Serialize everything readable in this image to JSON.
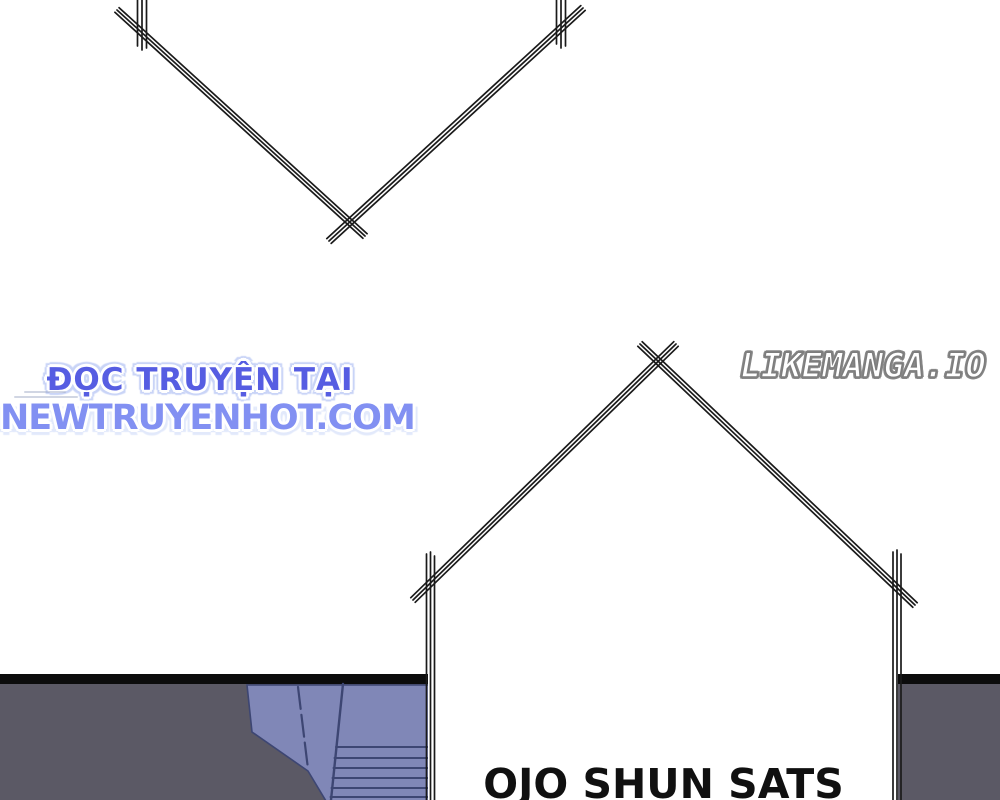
{
  "artwork": {
    "dialogue_text": "OJO SHUN SATS",
    "scene": "manga page with chevron panel border, house-shaped bubble outline, dark floor panel and blue staircase"
  },
  "watermarks": {
    "reader_line1": "ĐỌC TRUYỆN TẠI",
    "reader_line2": "NEWTRUYENHOT.COM",
    "site": "LIKEMANGA.IO"
  },
  "colors": {
    "reader_line1_blue": "#565de2",
    "reader_line2_blue": "#8290f2",
    "site_watermark_outline": "#7d7d7d",
    "panel_gray": "#5b5965",
    "panel_top_bar": "#0c0c0c",
    "stairs_blue": "#8087b7",
    "stairs_line_blue": "#3d4673",
    "ink_black": "#1a1a1a"
  }
}
